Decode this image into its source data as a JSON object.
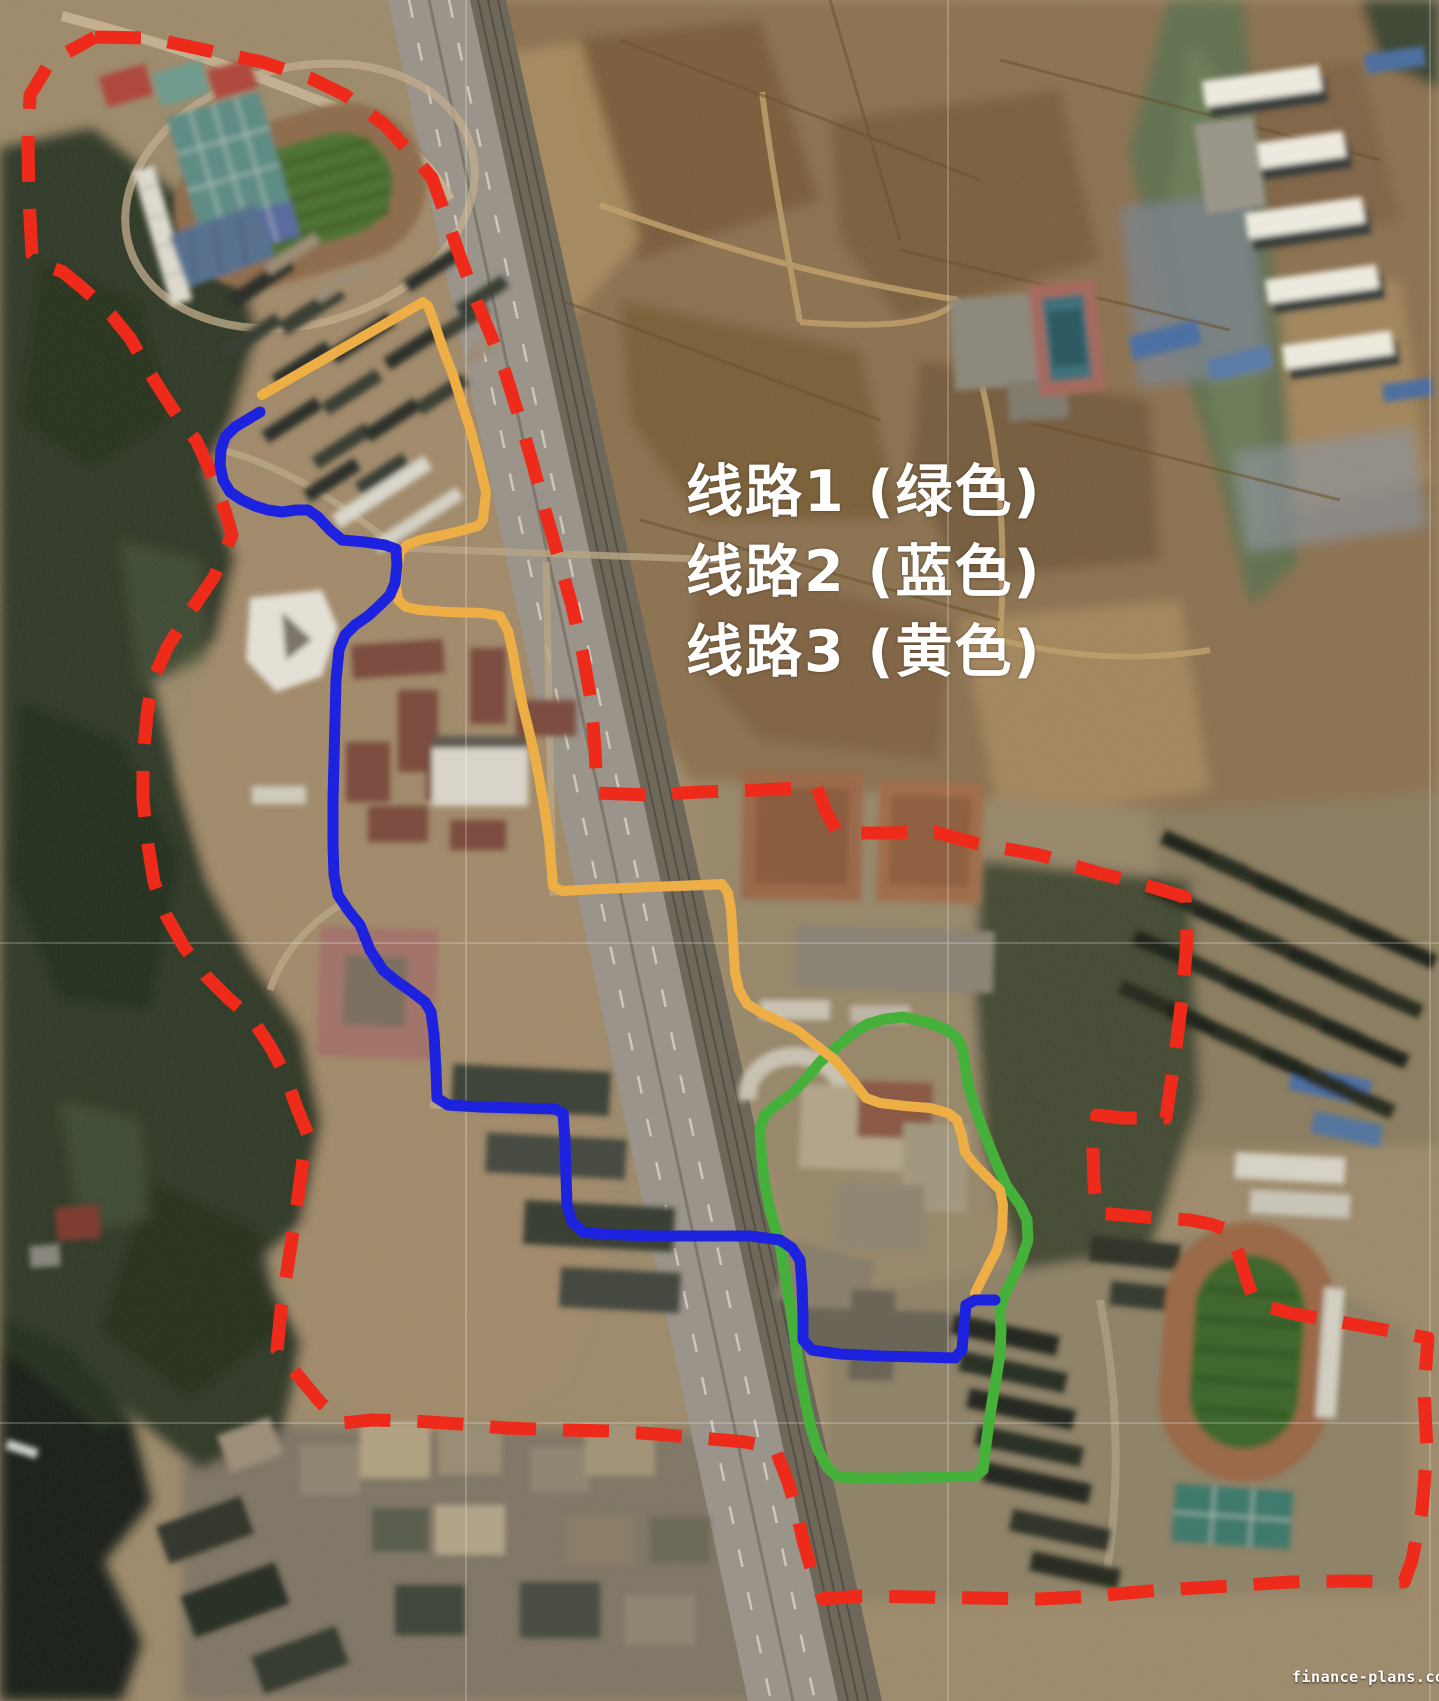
{
  "legend": {
    "lines": [
      {
        "route": "route-1",
        "text": "线路1 (绿色)",
        "color_name": "绿色",
        "color": "#46b13a"
      },
      {
        "route": "route-2",
        "text": "线路2 (蓝色)",
        "color_name": "蓝色",
        "color": "#1c22dd"
      },
      {
        "route": "route-3",
        "text": "线路3 (黄色)",
        "color_name": "黄色",
        "color": "#ecae45"
      }
    ]
  },
  "watermark": {
    "text": "finance-plans.com"
  },
  "overlays": {
    "boundary": {
      "name": "survey-boundary",
      "color": "#ee2b1a",
      "stroke_width": 13,
      "dash": [
        46,
        27
      ],
      "closed": true,
      "linecap": "butt",
      "points": [
        [
          95,
          37
        ],
        [
          150,
          38
        ],
        [
          205,
          50
        ],
        [
          262,
          62
        ],
        [
          310,
          78
        ],
        [
          345,
          95
        ],
        [
          385,
          125
        ],
        [
          415,
          158
        ],
        [
          432,
          178
        ],
        [
          448,
          222
        ],
        [
          462,
          262
        ],
        [
          476,
          300
        ],
        [
          492,
          338
        ],
        [
          505,
          372
        ],
        [
          520,
          420
        ],
        [
          533,
          465
        ],
        [
          545,
          510
        ],
        [
          558,
          556
        ],
        [
          572,
          606
        ],
        [
          583,
          655
        ],
        [
          591,
          700
        ],
        [
          595,
          748
        ],
        [
          597,
          793
        ],
        [
          650,
          795
        ],
        [
          700,
          792
        ],
        [
          760,
          790
        ],
        [
          817,
          787
        ],
        [
          826,
          812
        ],
        [
          838,
          833
        ],
        [
          885,
          833
        ],
        [
          935,
          832
        ],
        [
          975,
          843
        ],
        [
          1040,
          855
        ],
        [
          1095,
          872
        ],
        [
          1145,
          885
        ],
        [
          1185,
          897
        ],
        [
          1187,
          940
        ],
        [
          1183,
          990
        ],
        [
          1177,
          1040
        ],
        [
          1170,
          1090
        ],
        [
          1166,
          1118
        ],
        [
          1123,
          1118
        ],
        [
          1097,
          1115
        ],
        [
          1093,
          1150
        ],
        [
          1094,
          1185
        ],
        [
          1098,
          1213
        ],
        [
          1145,
          1217
        ],
        [
          1190,
          1220
        ],
        [
          1210,
          1224
        ],
        [
          1228,
          1230
        ],
        [
          1238,
          1252
        ],
        [
          1246,
          1278
        ],
        [
          1255,
          1303
        ],
        [
          1290,
          1313
        ],
        [
          1340,
          1322
        ],
        [
          1385,
          1330
        ],
        [
          1428,
          1338
        ],
        [
          1424,
          1390
        ],
        [
          1427,
          1450
        ],
        [
          1422,
          1510
        ],
        [
          1412,
          1560
        ],
        [
          1404,
          1582
        ],
        [
          1350,
          1581
        ],
        [
          1290,
          1582
        ],
        [
          1230,
          1586
        ],
        [
          1160,
          1590
        ],
        [
          1095,
          1596
        ],
        [
          1040,
          1599
        ],
        [
          980,
          1598
        ],
        [
          920,
          1597
        ],
        [
          862,
          1596
        ],
        [
          823,
          1599
        ],
        [
          812,
          1572
        ],
        [
          803,
          1540
        ],
        [
          795,
          1505
        ],
        [
          788,
          1482
        ],
        [
          775,
          1448
        ],
        [
          745,
          1442
        ],
        [
          700,
          1438
        ],
        [
          655,
          1434
        ],
        [
          610,
          1431
        ],
        [
          560,
          1430
        ],
        [
          505,
          1428
        ],
        [
          460,
          1424
        ],
        [
          413,
          1421
        ],
        [
          372,
          1420
        ],
        [
          343,
          1423
        ],
        [
          320,
          1402
        ],
        [
          300,
          1378
        ],
        [
          277,
          1350
        ],
        [
          281,
          1310
        ],
        [
          289,
          1258
        ],
        [
          297,
          1205
        ],
        [
          303,
          1160
        ],
        [
          308,
          1135
        ],
        [
          297,
          1108
        ],
        [
          284,
          1072
        ],
        [
          270,
          1046
        ],
        [
          252,
          1019
        ],
        [
          229,
          999
        ],
        [
          206,
          976
        ],
        [
          184,
          947
        ],
        [
          167,
          917
        ],
        [
          154,
          882
        ],
        [
          148,
          845
        ],
        [
          143,
          800
        ],
        [
          143,
          758
        ],
        [
          147,
          715
        ],
        [
          152,
          682
        ],
        [
          168,
          646
        ],
        [
          190,
          612
        ],
        [
          214,
          577
        ],
        [
          232,
          535
        ],
        [
          226,
          514
        ],
        [
          218,
          491
        ],
        [
          209,
          468
        ],
        [
          196,
          440
        ],
        [
          180,
          420
        ],
        [
          163,
          394
        ],
        [
          148,
          370
        ],
        [
          130,
          338
        ],
        [
          112,
          316
        ],
        [
          86,
          291
        ],
        [
          63,
          272
        ],
        [
          42,
          264
        ],
        [
          32,
          254
        ],
        [
          29,
          200
        ],
        [
          28,
          142
        ],
        [
          30,
          95
        ],
        [
          50,
          62
        ]
      ]
    },
    "routes": [
      {
        "name": "route-1-green",
        "color": "#46b13a",
        "stroke_width": 11,
        "closed": true,
        "points": [
          [
            868,
            1024
          ],
          [
            885,
            1019
          ],
          [
            903,
            1017
          ],
          [
            927,
            1022
          ],
          [
            947,
            1030
          ],
          [
            957,
            1038
          ],
          [
            962,
            1048
          ],
          [
            965,
            1065
          ],
          [
            968,
            1085
          ],
          [
            975,
            1108
          ],
          [
            985,
            1135
          ],
          [
            995,
            1160
          ],
          [
            1006,
            1185
          ],
          [
            1020,
            1205
          ],
          [
            1027,
            1220
          ],
          [
            1028,
            1240
          ],
          [
            1022,
            1258
          ],
          [
            1012,
            1280
          ],
          [
            1003,
            1298
          ],
          [
            1000,
            1310
          ],
          [
            1001,
            1330
          ],
          [
            1000,
            1355
          ],
          [
            995,
            1385
          ],
          [
            990,
            1415
          ],
          [
            986,
            1445
          ],
          [
            983,
            1470
          ],
          [
            975,
            1476
          ],
          [
            940,
            1477
          ],
          [
            900,
            1478
          ],
          [
            860,
            1478
          ],
          [
            838,
            1477
          ],
          [
            828,
            1468
          ],
          [
            818,
            1450
          ],
          [
            811,
            1428
          ],
          [
            806,
            1405
          ],
          [
            800,
            1375
          ],
          [
            795,
            1340
          ],
          [
            791,
            1310
          ],
          [
            785,
            1275
          ],
          [
            780,
            1245
          ],
          [
            770,
            1210
          ],
          [
            764,
            1180
          ],
          [
            761,
            1150
          ],
          [
            760,
            1128
          ],
          [
            765,
            1115
          ],
          [
            775,
            1106
          ],
          [
            790,
            1095
          ],
          [
            805,
            1080
          ],
          [
            820,
            1062
          ],
          [
            838,
            1046
          ],
          [
            855,
            1032
          ]
        ]
      },
      {
        "name": "route-3-yellow",
        "color": "#ecae45",
        "stroke_width": 10,
        "closed": false,
        "points": [
          [
            262,
            395
          ],
          [
            300,
            373
          ],
          [
            423,
            302
          ],
          [
            428,
            306
          ],
          [
            432,
            316
          ],
          [
            444,
            352
          ],
          [
            452,
            372
          ],
          [
            462,
            404
          ],
          [
            470,
            428
          ],
          [
            478,
            458
          ],
          [
            486,
            492
          ],
          [
            483,
            520
          ],
          [
            478,
            526
          ],
          [
            452,
            533
          ],
          [
            420,
            540
          ],
          [
            407,
            545
          ],
          [
            400,
            552
          ],
          [
            398,
            565
          ],
          [
            396,
            585
          ],
          [
            398,
            600
          ],
          [
            406,
            607
          ],
          [
            420,
            610
          ],
          [
            447,
            612
          ],
          [
            483,
            613
          ],
          [
            500,
            616
          ],
          [
            508,
            631
          ],
          [
            513,
            653
          ],
          [
            517,
            677
          ],
          [
            523,
            707
          ],
          [
            529,
            731
          ],
          [
            535,
            757
          ],
          [
            540,
            783
          ],
          [
            545,
            812
          ],
          [
            549,
            840
          ],
          [
            551,
            862
          ],
          [
            553,
            886
          ],
          [
            562,
            891
          ],
          [
            600,
            889
          ],
          [
            650,
            887
          ],
          [
            700,
            885
          ],
          [
            722,
            884
          ],
          [
            728,
            893
          ],
          [
            731,
            910
          ],
          [
            733,
            940
          ],
          [
            735,
            972
          ],
          [
            739,
            990
          ],
          [
            747,
            1004
          ],
          [
            762,
            1013
          ],
          [
            782,
            1023
          ],
          [
            797,
            1030
          ],
          [
            817,
            1046
          ],
          [
            835,
            1060
          ],
          [
            852,
            1080
          ],
          [
            866,
            1098
          ],
          [
            880,
            1103
          ],
          [
            905,
            1106
          ],
          [
            930,
            1108
          ],
          [
            948,
            1113
          ],
          [
            957,
            1120
          ],
          [
            962,
            1136
          ],
          [
            965,
            1152
          ],
          [
            975,
            1165
          ],
          [
            988,
            1178
          ],
          [
            1000,
            1190
          ],
          [
            1003,
            1205
          ],
          [
            1002,
            1230
          ],
          [
            997,
            1250
          ],
          [
            989,
            1265
          ],
          [
            980,
            1283
          ],
          [
            975,
            1293
          ]
        ]
      },
      {
        "name": "route-2-blue",
        "color": "#1c22dd",
        "stroke_width": 11,
        "closed": false,
        "points": [
          [
            260,
            412
          ],
          [
            250,
            418
          ],
          [
            235,
            427
          ],
          [
            225,
            437
          ],
          [
            221,
            450
          ],
          [
            220,
            465
          ],
          [
            223,
            480
          ],
          [
            230,
            492
          ],
          [
            242,
            500
          ],
          [
            255,
            506
          ],
          [
            268,
            510
          ],
          [
            282,
            512
          ],
          [
            296,
            510
          ],
          [
            308,
            510
          ],
          [
            318,
            517
          ],
          [
            330,
            530
          ],
          [
            342,
            540
          ],
          [
            365,
            542
          ],
          [
            385,
            545
          ],
          [
            396,
            549
          ],
          [
            397,
            565
          ],
          [
            395,
            583
          ],
          [
            390,
            595
          ],
          [
            380,
            605
          ],
          [
            368,
            616
          ],
          [
            355,
            625
          ],
          [
            345,
            635
          ],
          [
            339,
            650
          ],
          [
            336,
            680
          ],
          [
            335,
            720
          ],
          [
            334,
            760
          ],
          [
            333,
            800
          ],
          [
            333,
            845
          ],
          [
            334,
            875
          ],
          [
            338,
            895
          ],
          [
            348,
            910
          ],
          [
            360,
            925
          ],
          [
            370,
            950
          ],
          [
            383,
            970
          ],
          [
            395,
            980
          ],
          [
            412,
            992
          ],
          [
            425,
            1002
          ],
          [
            431,
            1012
          ],
          [
            434,
            1035
          ],
          [
            436,
            1070
          ],
          [
            437,
            1098
          ],
          [
            448,
            1105
          ],
          [
            480,
            1107
          ],
          [
            520,
            1108
          ],
          [
            555,
            1109
          ],
          [
            563,
            1113
          ],
          [
            565,
            1140
          ],
          [
            566,
            1175
          ],
          [
            567,
            1205
          ],
          [
            572,
            1222
          ],
          [
            583,
            1232
          ],
          [
            600,
            1234
          ],
          [
            650,
            1236
          ],
          [
            700,
            1236
          ],
          [
            750,
            1236
          ],
          [
            780,
            1240
          ],
          [
            792,
            1248
          ],
          [
            800,
            1260
          ],
          [
            802,
            1285
          ],
          [
            803,
            1315
          ],
          [
            803,
            1340
          ],
          [
            812,
            1350
          ],
          [
            840,
            1354
          ],
          [
            880,
            1356
          ],
          [
            920,
            1357
          ],
          [
            955,
            1358
          ],
          [
            962,
            1350
          ],
          [
            964,
            1325
          ],
          [
            966,
            1305
          ],
          [
            975,
            1300
          ],
          [
            995,
            1300
          ]
        ]
      }
    ]
  }
}
